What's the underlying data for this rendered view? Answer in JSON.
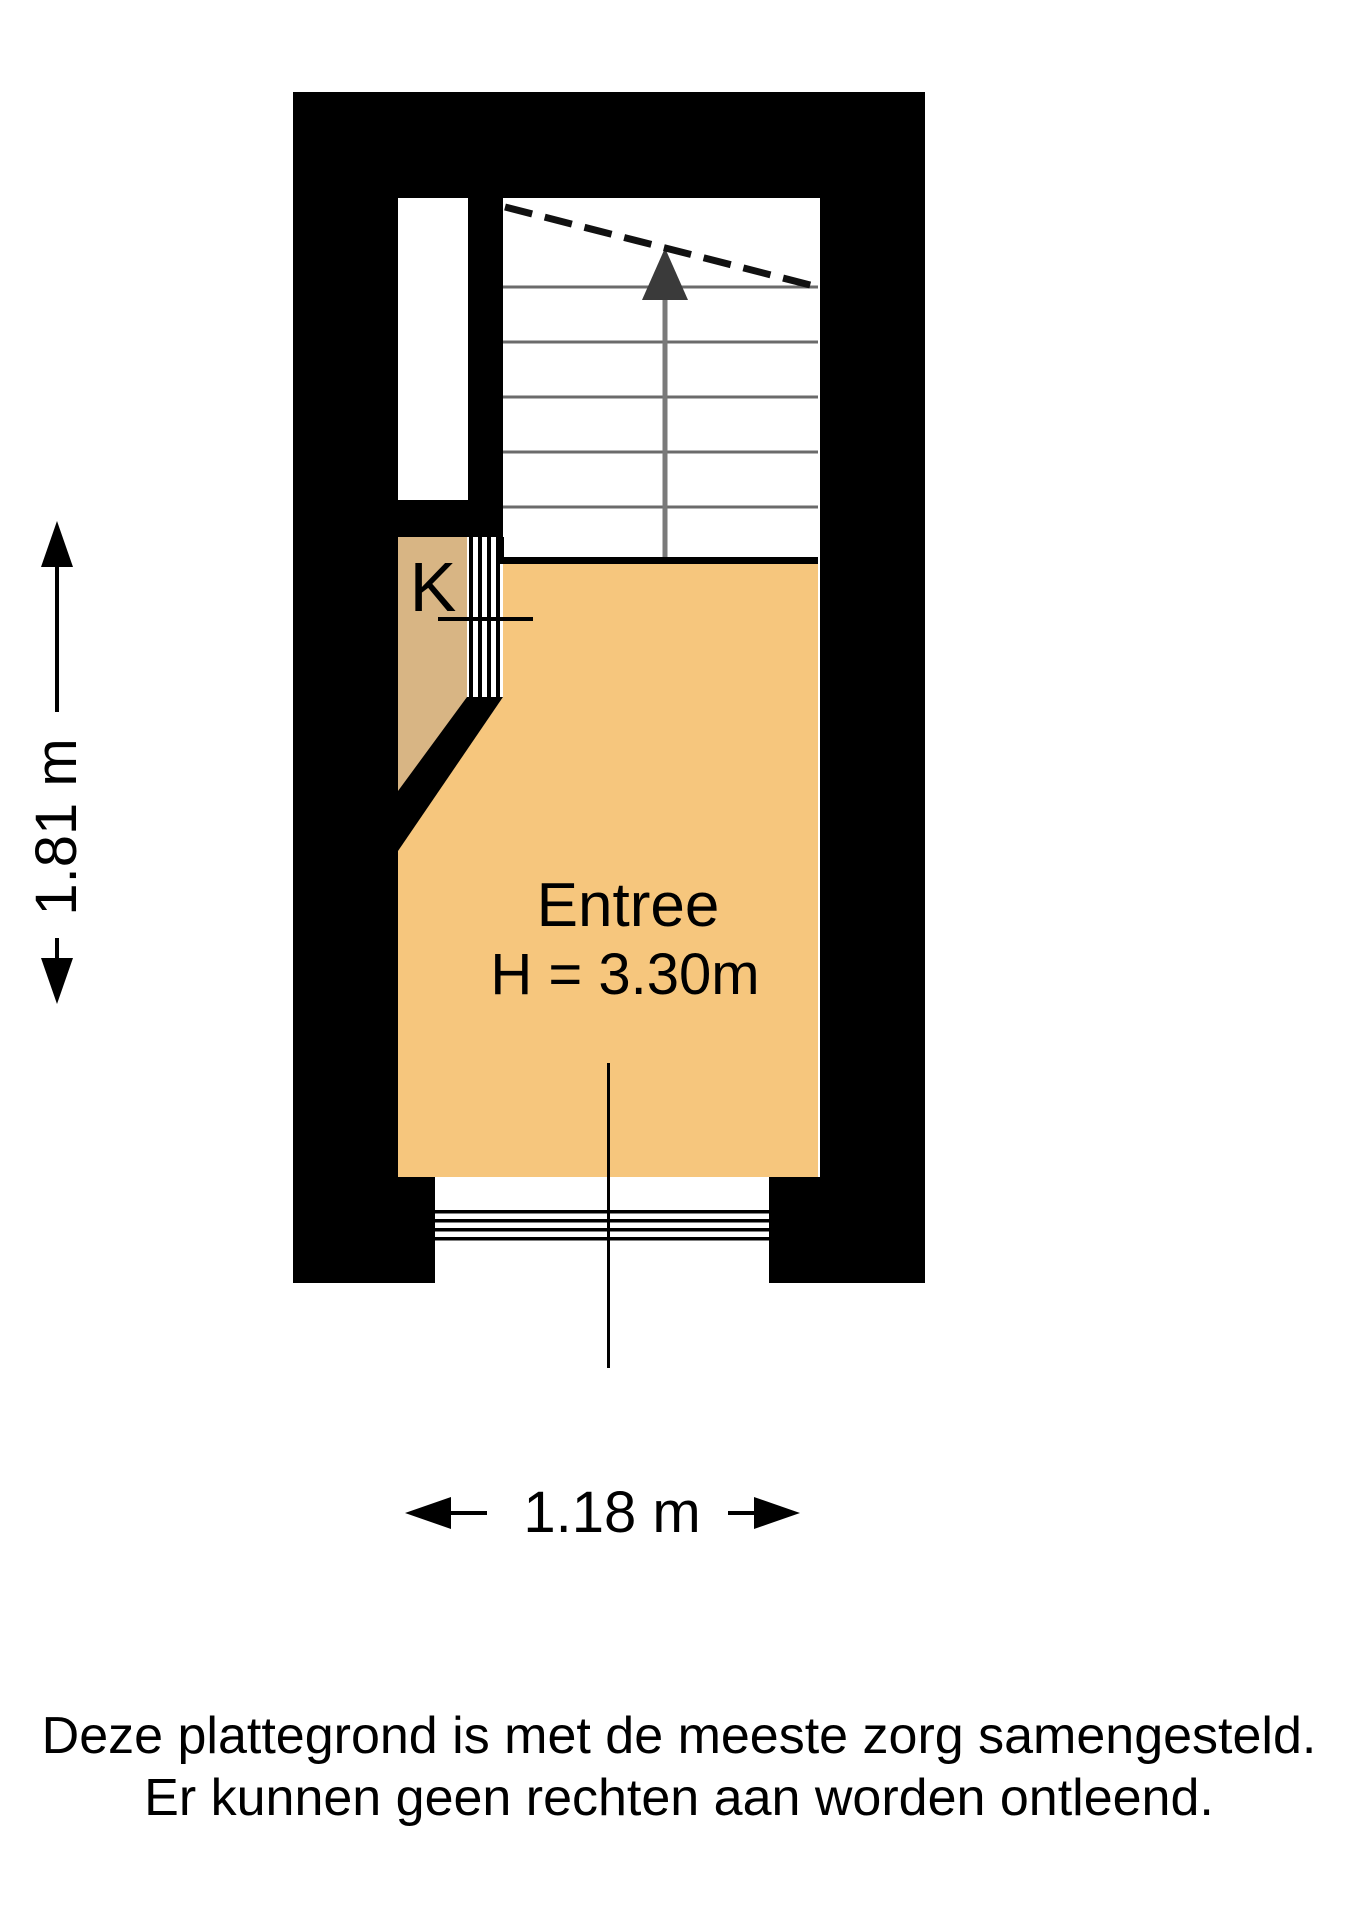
{
  "plan": {
    "room": {
      "name": "Entree",
      "ceiling_height": "H = 3.30m"
    },
    "closet": {
      "label": "K"
    },
    "dimensions": {
      "vertical": "1.81 m",
      "horizontal": "1.18 m"
    }
  },
  "disclaimer": {
    "line1": "Deze plattegrond is met de meeste zorg samengesteld.",
    "line2": "Er kunnen geen rechten aan worden ontleend."
  },
  "colors": {
    "wall": "#000000",
    "floor": "#F6C67D",
    "closet_floor": "#D8B584",
    "stair_bg": "#FFFFFF",
    "tread": "#6B6B6B",
    "stair_arrow_head": "#3A3A3A",
    "stair_arrow_stem": "#7A7A7A",
    "line": "#111111"
  }
}
